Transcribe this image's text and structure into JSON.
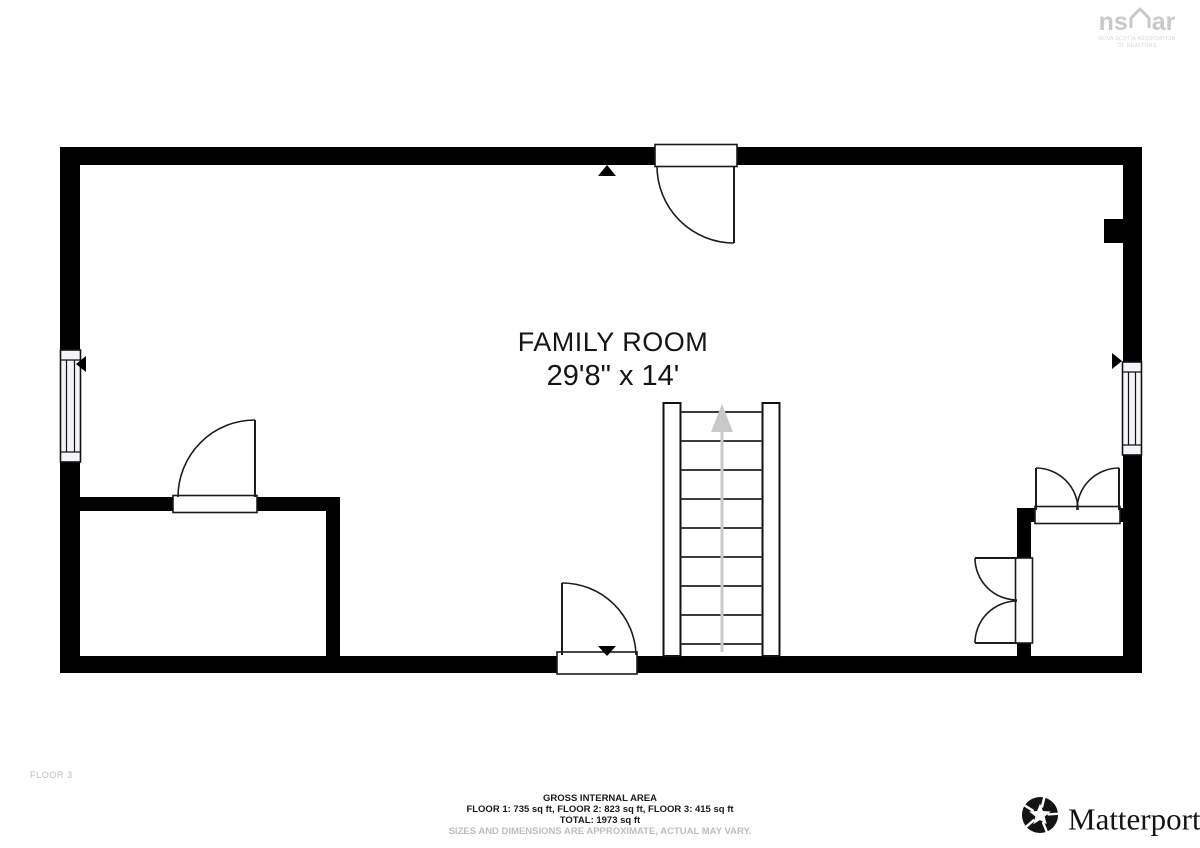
{
  "room": {
    "name": "FAMILY ROOM",
    "dimensions": "29'8\" x 14'"
  },
  "floor_label": "FLOOR 3",
  "footer": {
    "title": "GROSS INTERNAL AREA",
    "floors": "FLOOR 1: 735 sq ft, FLOOR 2: 823 sq ft, FLOOR 3: 415 sq ft",
    "total": "TOTAL: 1973 sq ft",
    "disclaimer": "SIZES AND DIMENSIONS ARE APPROXIMATE, ACTUAL MAY VARY."
  },
  "logos": {
    "nsar": {
      "prefix": "ns",
      "suffix": "ar",
      "caption_line1": "NOVA SCOTIA ASSOCIATION",
      "caption_line2": "OF REALTORS"
    },
    "matterport": {
      "name": "Matterport",
      "trademark": "®"
    }
  },
  "colors": {
    "wall": "#000000",
    "text": "#151515",
    "muted": "#bdbdbd",
    "logo_gray": "#c9c9c9",
    "stair_arrow": "#c9c9c9",
    "window_fill": "#f4f4f8"
  }
}
